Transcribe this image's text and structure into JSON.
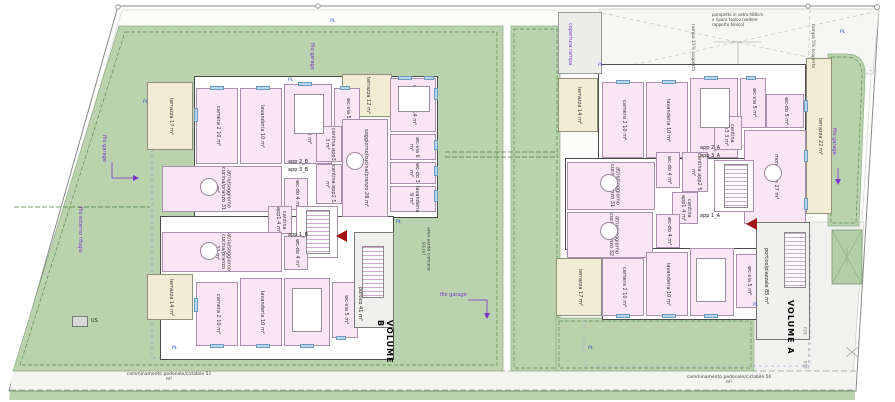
{
  "colors": {
    "lawn": "#bad3ae",
    "room_pink": "#f9e6f4",
    "terrace": "#f1ecd3",
    "annotation_purple": "#7d35cc",
    "pl_blue": "#3350c8",
    "entry_marker_red": "#a21313"
  },
  "site": {
    "volume_a": "VOLUME A",
    "volume_b": "VOLUME B",
    "p29": "P29",
    "p30": "P30",
    "pl": "PL",
    "us": "US",
    "filo_garage": "filo garage",
    "filo_esterno_rifugio": "filo esterno rifugio",
    "copertura_rampa": "copertura rampa",
    "rampa_15": "rampa 15% scoperta",
    "rampa_5": "rampa 5% scoperta",
    "parapetto_note": "parapetto in vetro h80cm x riparo fonico (vedere rapporto fonico)",
    "area_verde": "area verde comune 93 m²",
    "camminamento_sx": "camminamento pedonale/ciclabile 51 m²",
    "camminamento_dx": "camminamento pedonale/ciclabile 56 m²"
  },
  "rooms": {
    "camera2_10": "camera 2 10 m²",
    "lavanderia_10": "lavanderia 10 m²",
    "camera1_15": "camera 1 15 m²",
    "camera1_14": "camera 1 14 m²",
    "wc_via_5": "wc-via 5 m²",
    "wc_via_6": "wc-via 6 m²",
    "wc_do_3": "wc-do 3 m²",
    "wc_do_4": "wc-do 4 m²",
    "wc_do_5": "wc-do 5 m²",
    "lavanderia_9": "lavanderia 9 m²",
    "soggiorno_28": "soggiorno/cucina/pranzo 28 m²",
    "atrio_31": "atrio/soggiorno cucina/pranzo 31 m²",
    "atrio_32": "atrio/soggiorno cucina/pranzo 32 m²",
    "cantina_app1": "cantina app1 4 m²",
    "cantina_app2": "cantina app2 5 m²",
    "cantina_app3": "cantina app3 3 m²",
    "vano_scale": "vano scale 16 m²",
    "monolocale": "monolocale 27 m²",
    "terrazza_17": "terrazza 17 m²",
    "terrazza_12": "terrazza 12 m²",
    "terrazza_14": "terrazza 14 m²",
    "terrazza_22": "terrazza 22 m²",
    "portico_41": "portico 41 m²",
    "portico_piazzale_85": "portico/piazzale 85 m²"
  },
  "apartments": {
    "app1_b": "app 1_B",
    "app2_b": "app 2_B",
    "app3_b": "app 3_B",
    "app1_a": "app 1_A",
    "app2_a": "app 2_A",
    "app3_a": "app 3_A"
  }
}
